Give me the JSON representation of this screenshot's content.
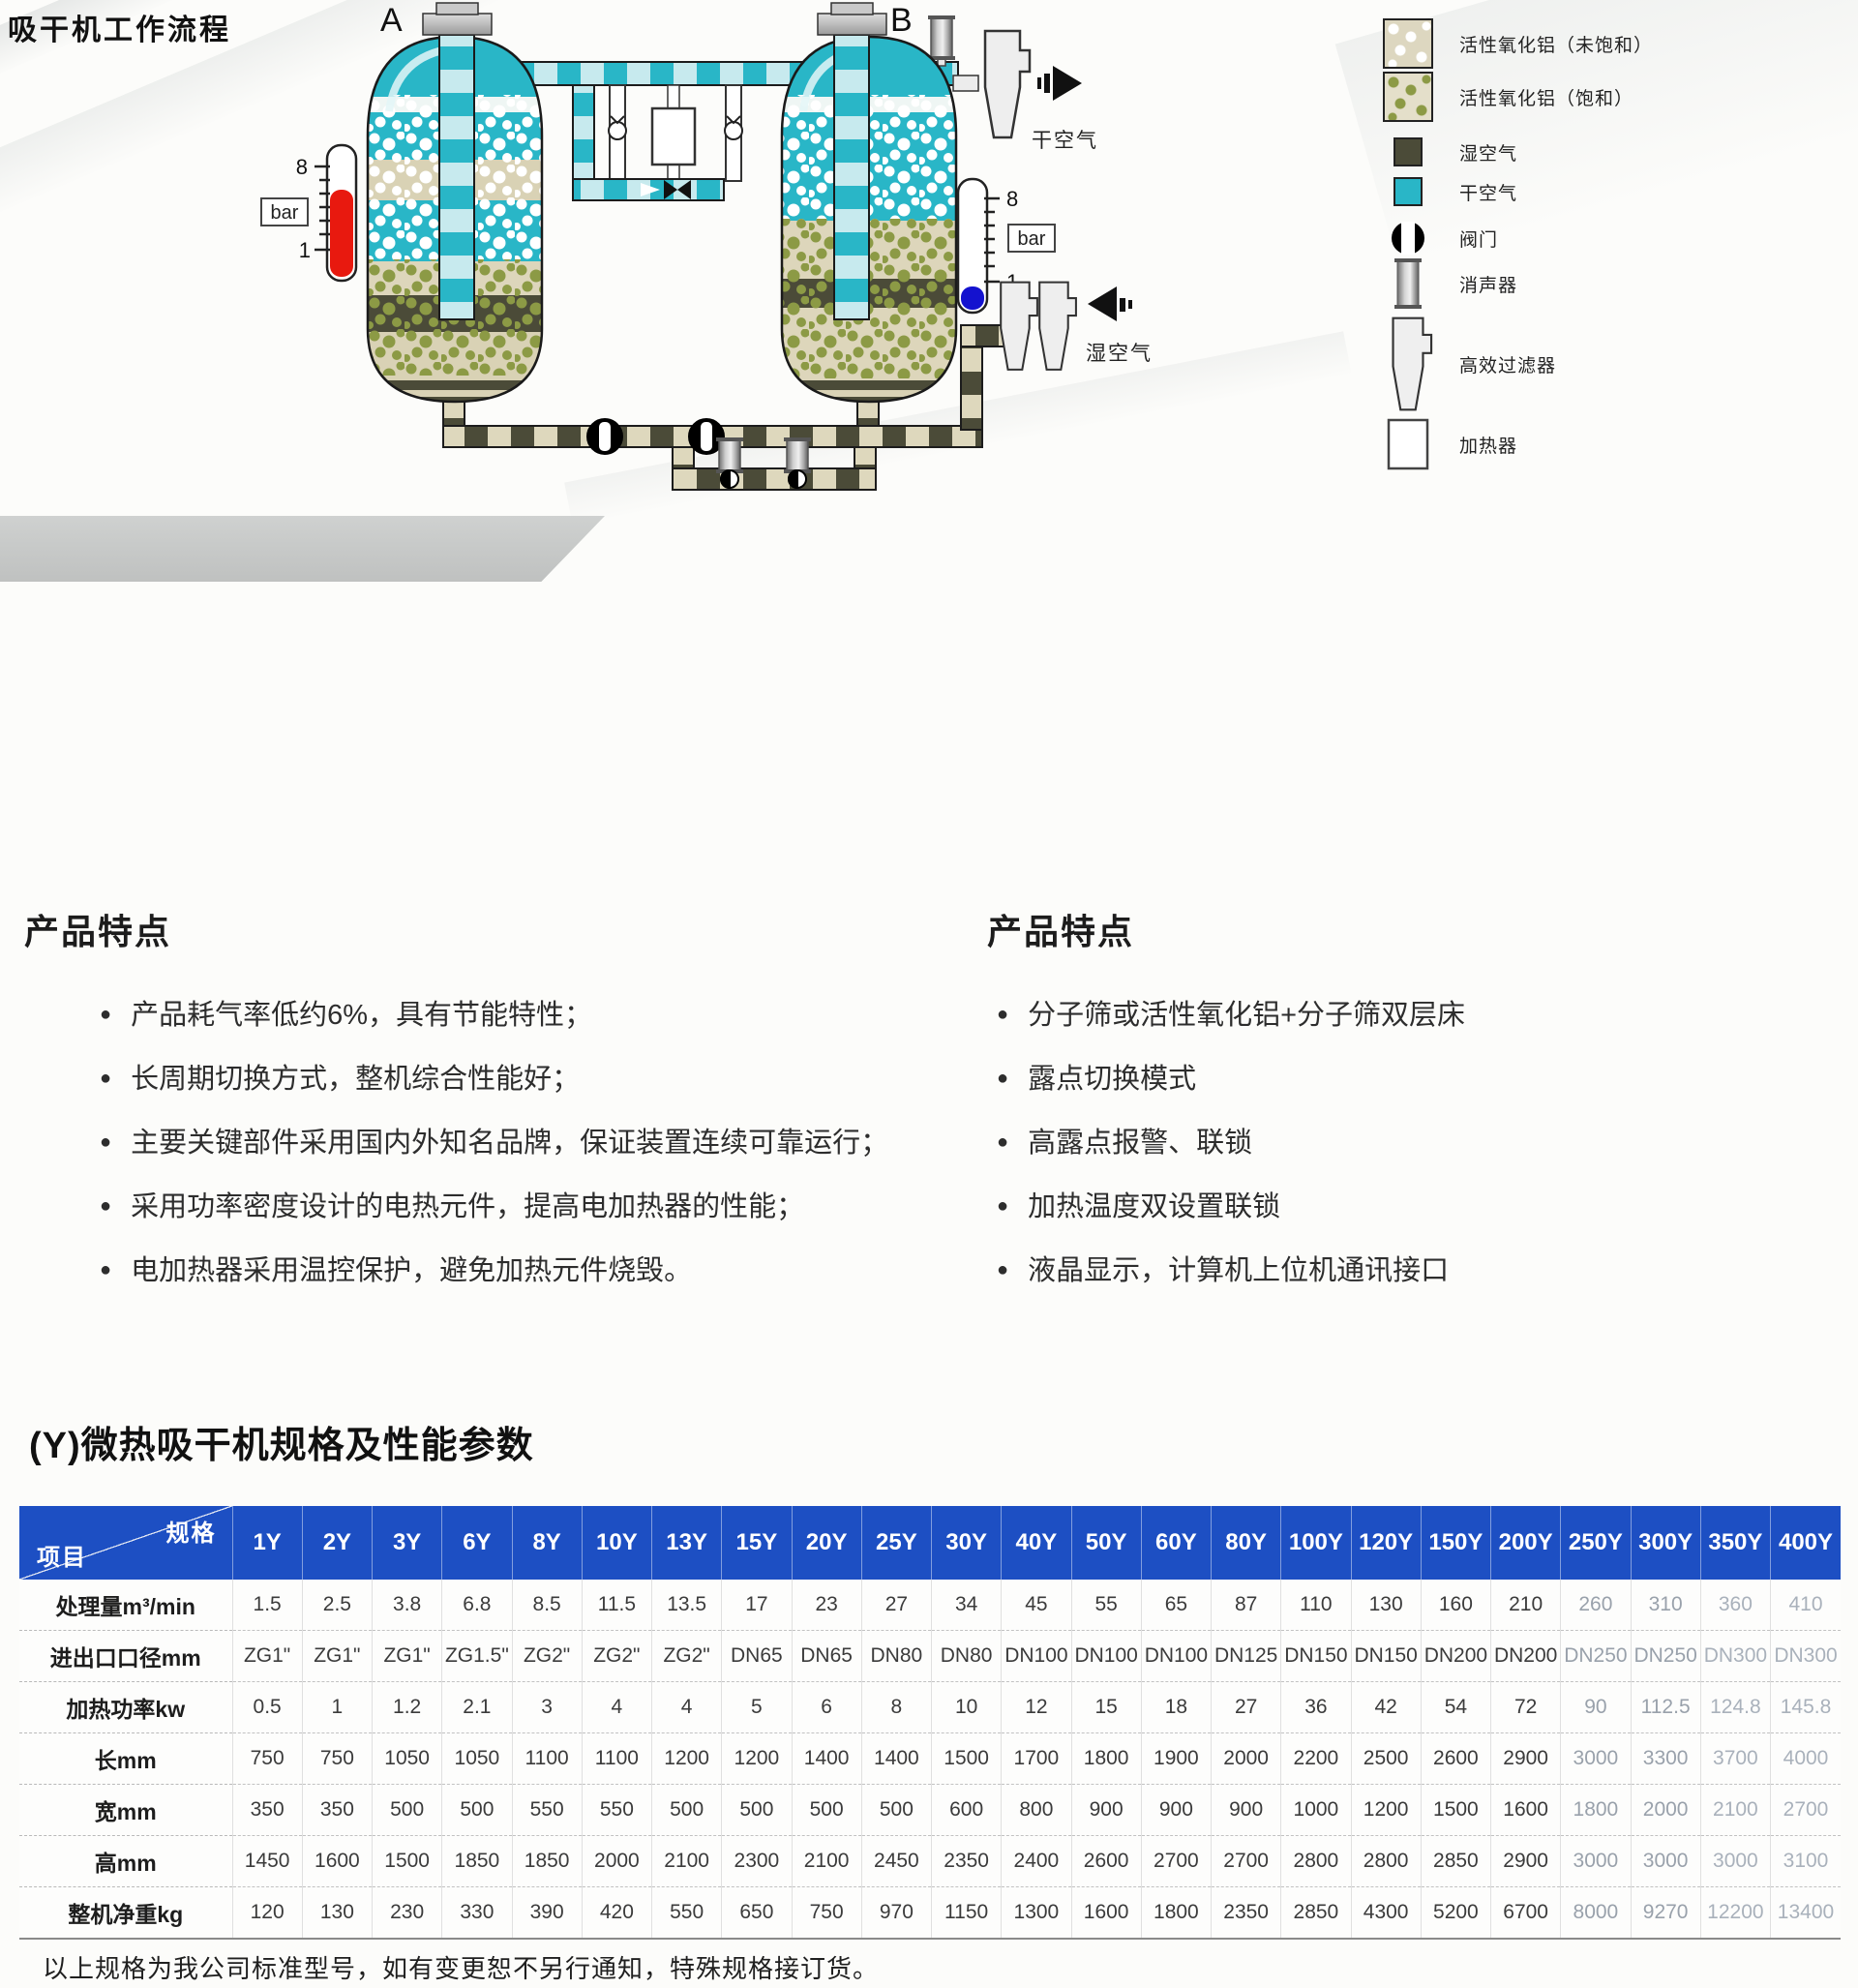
{
  "colors": {
    "teal": "#29b6c7",
    "tealLight": "#c7eaee",
    "oliveDark": "#4b4b38",
    "beige": "#d9d2b5",
    "oliveDot": "#8c9a45",
    "gaugeRed": "#e8190f",
    "gaugeBlue": "#1412cf",
    "headerBlue": "#1d4fc3"
  },
  "diagram": {
    "title": "吸干机工作流程",
    "vessel_a_label": "A",
    "vessel_b_label": "B",
    "gauge_max": "8",
    "gauge_min": "1",
    "bar_label": "bar",
    "dry_air_label": "干空气",
    "wet_air_label": "湿空气"
  },
  "legend": {
    "items": [
      {
        "name": "alumina-unsaturated",
        "label": "活性氧化铝（未饱和）"
      },
      {
        "name": "alumina-saturated",
        "label": "活性氧化铝（饱和）"
      },
      {
        "name": "wet-air",
        "label": "湿空气"
      },
      {
        "name": "dry-air",
        "label": "干空气"
      },
      {
        "name": "valve",
        "label": "阀门"
      },
      {
        "name": "muffler",
        "label": "消声器"
      },
      {
        "name": "hepa-filter",
        "label": "高效过滤器"
      },
      {
        "name": "heater",
        "label": "加热器"
      }
    ]
  },
  "features_left": {
    "title": "产品特点",
    "items": [
      "产品耗气率低约6%，具有节能特性；",
      "长周期切换方式，整机综合性能好；",
      "主要关键部件采用国内外知名品牌，保证装置连续可靠运行；",
      "采用功率密度设计的电热元件，提高电加热器的性能；",
      "电加热器采用温控保护，避免加热元件烧毁。"
    ]
  },
  "features_right": {
    "title": "产品特点",
    "items": [
      "分子筛或活性氧化铝+分子筛双层床",
      "露点切换模式",
      "高露点报警、联锁",
      "加热温度双设置联锁",
      "液晶显示，计算机上位机通讯接口"
    ]
  },
  "spec_table": {
    "title": "(Y)微热吸干机规格及性能参数",
    "corner": {
      "top_right": "规格",
      "bottom_left": "项目"
    },
    "columns": [
      "1Y",
      "2Y",
      "3Y",
      "6Y",
      "8Y",
      "10Y",
      "13Y",
      "15Y",
      "20Y",
      "25Y",
      "30Y",
      "40Y",
      "50Y",
      "60Y",
      "80Y",
      "100Y",
      "120Y",
      "150Y",
      "200Y",
      "250Y",
      "300Y",
      "350Y",
      "400Y"
    ],
    "rows": [
      {
        "label": "处理量m³/min",
        "values": [
          "1.5",
          "2.5",
          "3.8",
          "6.8",
          "8.5",
          "11.5",
          "13.5",
          "17",
          "23",
          "27",
          "34",
          "45",
          "55",
          "65",
          "87",
          "110",
          "130",
          "160",
          "210",
          "260",
          "310",
          "360",
          "410"
        ]
      },
      {
        "label": "进出口口径mm",
        "values": [
          "ZG1\"",
          "ZG1\"",
          "ZG1\"",
          "ZG1.5\"",
          "ZG2\"",
          "ZG2\"",
          "ZG2\"",
          "DN65",
          "DN65",
          "DN80",
          "DN80",
          "DN100",
          "DN100",
          "DN100",
          "DN125",
          "DN150",
          "DN150",
          "DN200",
          "DN200",
          "DN250",
          "DN250",
          "DN300",
          "DN300"
        ]
      },
      {
        "label": "加热功率kw",
        "values": [
          "0.5",
          "1",
          "1.2",
          "2.1",
          "3",
          "4",
          "4",
          "5",
          "6",
          "8",
          "10",
          "12",
          "15",
          "18",
          "27",
          "36",
          "42",
          "54",
          "72",
          "90",
          "112.5",
          "124.8",
          "145.8"
        ]
      },
      {
        "label": "长mm",
        "values": [
          "750",
          "750",
          "1050",
          "1050",
          "1100",
          "1100",
          "1200",
          "1200",
          "1400",
          "1400",
          "1500",
          "1700",
          "1800",
          "1900",
          "2000",
          "2200",
          "2500",
          "2600",
          "2900",
          "3000",
          "3300",
          "3700",
          "4000"
        ]
      },
      {
        "label": "宽mm",
        "values": [
          "350",
          "350",
          "500",
          "500",
          "550",
          "550",
          "500",
          "500",
          "500",
          "500",
          "600",
          "800",
          "900",
          "900",
          "900",
          "1000",
          "1200",
          "1500",
          "1600",
          "1800",
          "2000",
          "2100",
          "2700"
        ]
      },
      {
        "label": "高mm",
        "values": [
          "1450",
          "1600",
          "1500",
          "1850",
          "1850",
          "2000",
          "2100",
          "2300",
          "2100",
          "2450",
          "2350",
          "2400",
          "2600",
          "2700",
          "2700",
          "2800",
          "2800",
          "2850",
          "2900",
          "3000",
          "3000",
          "3000",
          "3100"
        ]
      },
      {
        "label": "整机净重kg",
        "values": [
          "120",
          "130",
          "230",
          "330",
          "390",
          "420",
          "550",
          "650",
          "750",
          "970",
          "1150",
          "1300",
          "1600",
          "1800",
          "2350",
          "2850",
          "4300",
          "5200",
          "6700",
          "8000",
          "9270",
          "12200",
          "13400"
        ]
      }
    ],
    "footnote": "以上规格为我公司标准型号，如有变更恕不另行通知，特殊规格接订货。"
  }
}
